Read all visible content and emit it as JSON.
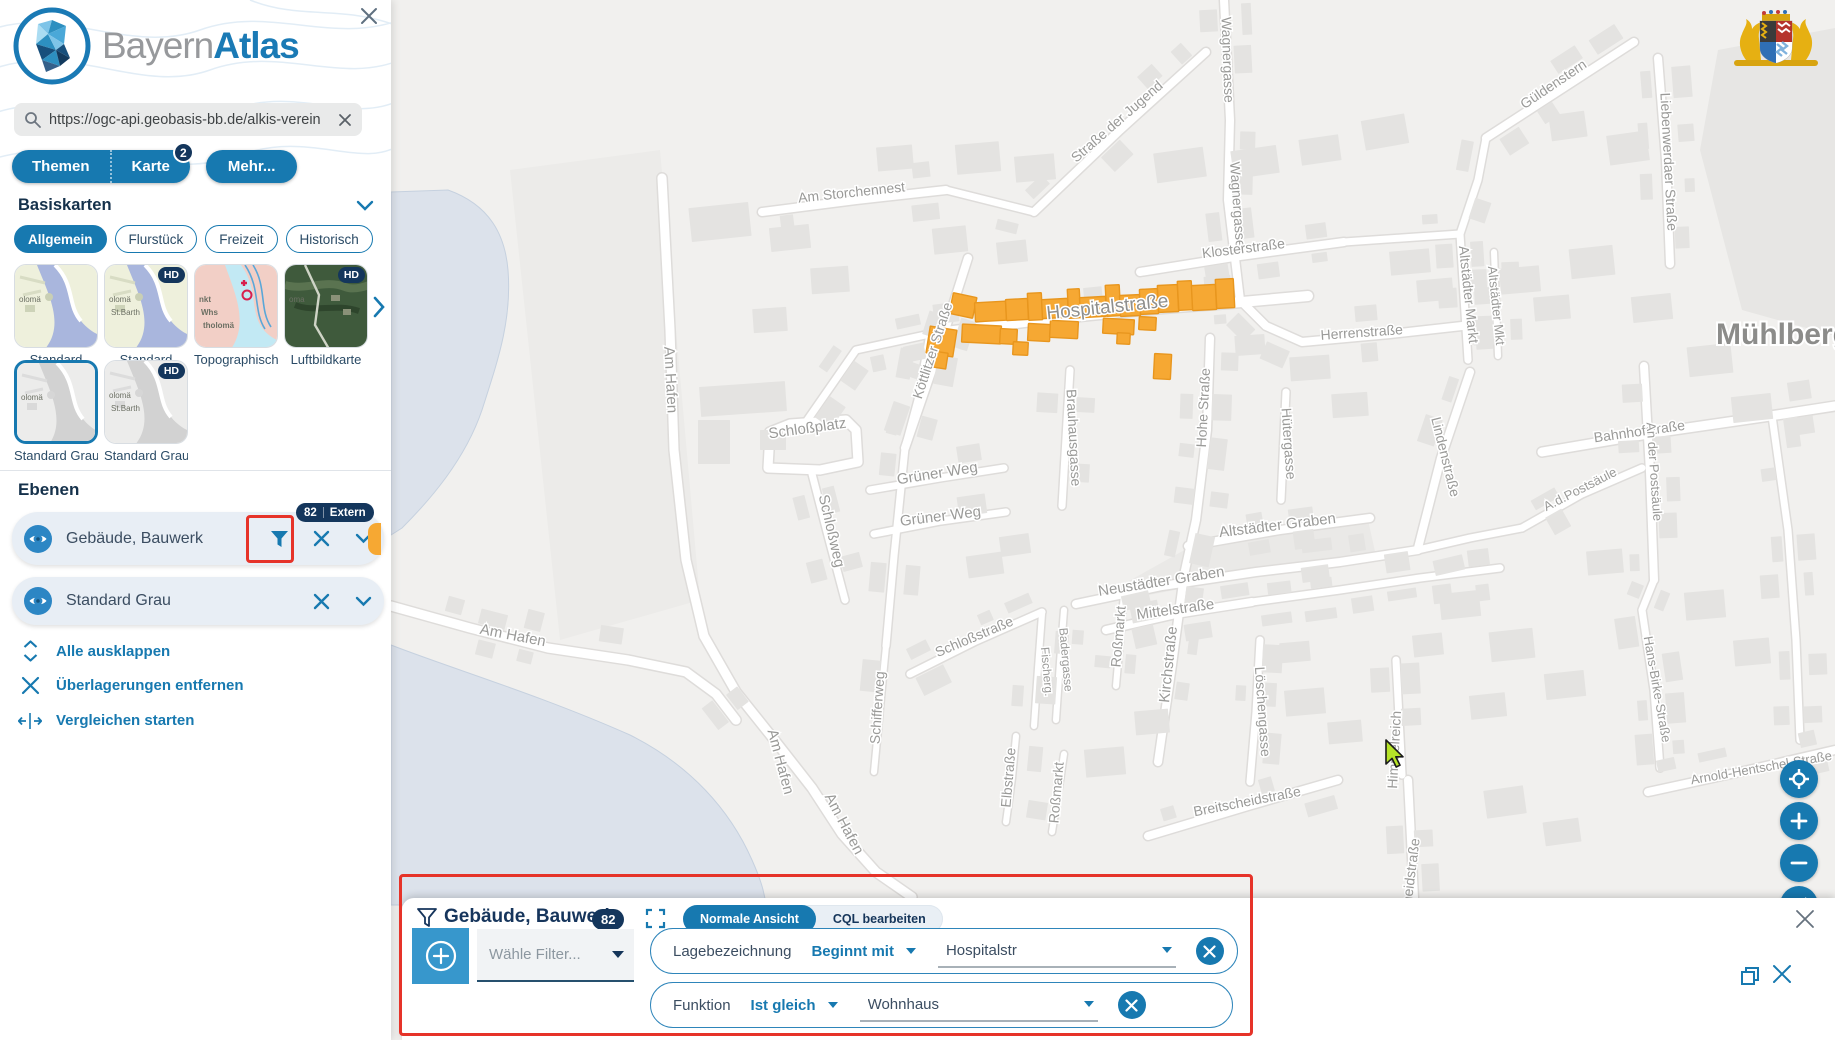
{
  "colors": {
    "primary": "#1779b0",
    "navy": "#14365c",
    "accent_orange": "#F6A833",
    "annotation_red": "#e63329",
    "layer_row_bg": "#e8eef5",
    "map_bg": "#f1f0ee",
    "water": "#dce2eb",
    "building": "#e4e3e1",
    "highlight_fill": "#F6A833",
    "highlight_stroke": "#E8961E"
  },
  "icons": [
    "close-icon",
    "search-icon",
    "chevron-down-icon",
    "chevron-right-icon",
    "filter-icon",
    "eye-icon",
    "expand-icon",
    "fullscreen-icon",
    "compare-icon",
    "plus-circle-icon",
    "zoom-in-icon",
    "zoom-out-icon",
    "geolocate-icon",
    "compass-icon",
    "restore-window-icon",
    "bavaria-coat-of-arms",
    "cursor-arrow"
  ],
  "sidebar": {
    "brand_gray": "Bayern",
    "brand_bold": "Atlas",
    "search": {
      "value": "https://ogc-api.geobasis-bb.de/alkis-verein"
    },
    "tabs": [
      {
        "label": "Themen"
      },
      {
        "label": "Karte",
        "badge": "2"
      },
      {
        "label": "Mehr..."
      }
    ],
    "basiskarten": {
      "title": "Basiskarten",
      "chips": [
        {
          "label": "Allgemein",
          "active": true
        },
        {
          "label": "Flurstück",
          "active": false
        },
        {
          "label": "Freizeit",
          "active": false
        },
        {
          "label": "Historisch",
          "active": false
        }
      ],
      "thumbs_row1": [
        {
          "label": "Standard",
          "variant": "standard",
          "hd": false,
          "overlay": [
            "olomä"
          ]
        },
        {
          "label": "Standard",
          "variant": "standard",
          "hd": true,
          "overlay": [
            "olomä",
            "St.Barth"
          ]
        },
        {
          "label": "Topographisch",
          "variant": "topo",
          "hd": false,
          "overlay": [
            "nkt",
            "Whs",
            "tholomä"
          ]
        },
        {
          "label": "Luftbildkarte",
          "variant": "aerial",
          "hd": true,
          "overlay": [
            "oma"
          ]
        }
      ],
      "thumbs_row2": [
        {
          "label": "Standard Grau",
          "variant": "gray",
          "hd": false,
          "selected": true,
          "overlay": [
            "olomä"
          ]
        },
        {
          "label": "Standard Grau",
          "variant": "gray",
          "hd": true,
          "overlay": [
            "olomä",
            "St.Barth"
          ]
        }
      ],
      "hd_badge": "HD"
    },
    "ebenen": {
      "title": "Ebenen",
      "layers": [
        {
          "label": "Gebäude, Bauwerk",
          "badge_count": "82",
          "badge_text": "Extern",
          "has_filter": true,
          "has_orange_handle": true
        },
        {
          "label": "Standard Grau",
          "has_filter": false
        }
      ],
      "actions": [
        {
          "label": "Alle ausklappen",
          "icon": "expand-vertical-icon"
        },
        {
          "label": "Überlagerungen entfernen",
          "icon": "close-icon"
        },
        {
          "label": "Vergleichen starten",
          "icon": "compare-icon"
        }
      ]
    }
  },
  "filter_panel": {
    "title": "Gebäude, Bauwerk",
    "count": "82",
    "view_toggle": [
      {
        "label": "Normale Ansicht",
        "active": true
      },
      {
        "label": "CQL bearbeiten",
        "active": false
      }
    ],
    "select_placeholder": "Wähle Filter...",
    "filters": [
      {
        "field": "Lagebezeichnung",
        "operator": "Beginnt mit",
        "value": "Hospitalstr"
      },
      {
        "field": "Funktion",
        "operator": "Ist gleich",
        "value": "Wohnhaus"
      }
    ]
  },
  "map": {
    "place_label": "Mühlberg",
    "street_labels": [
      {
        "t": "Wagnergasse",
        "x": 1223,
        "y": 60,
        "r": 88,
        "s": 14
      },
      {
        "t": "Wagnergasse",
        "x": 1233,
        "y": 205,
        "r": 86,
        "s": 14
      },
      {
        "t": "Straße der Jugend",
        "x": 1120,
        "y": 125,
        "r": -41,
        "s": 14
      },
      {
        "t": "Am Storchennest",
        "x": 852,
        "y": 197,
        "r": -6,
        "s": 14
      },
      {
        "t": "Güldenstern",
        "x": 1556,
        "y": 88,
        "r": -34,
        "s": 14
      },
      {
        "t": "Liebenwerdaer Straße",
        "x": 1664,
        "y": 162,
        "r": 87,
        "s": 14
      },
      {
        "t": "Klosterstraße",
        "x": 1244,
        "y": 253,
        "r": -7,
        "s": 14
      },
      {
        "t": "Altstädter Markt",
        "x": 1464,
        "y": 295,
        "r": 84,
        "s": 14
      },
      {
        "t": "Altstädter Mkt",
        "x": 1492,
        "y": 306,
        "r": 84,
        "s": 13
      },
      {
        "t": "Herrenstraße",
        "x": 1362,
        "y": 337,
        "r": -4,
        "s": 14
      },
      {
        "t": "Hohe Straße",
        "x": 1208,
        "y": 408,
        "r": -87,
        "s": 14
      },
      {
        "t": "Hütergasse",
        "x": 1284,
        "y": 444,
        "r": 86,
        "s": 14
      },
      {
        "t": "Lindenstraße",
        "x": 1441,
        "y": 458,
        "r": 76,
        "s": 14
      },
      {
        "t": "Bahnhofstraße",
        "x": 1640,
        "y": 436,
        "r": -8,
        "s": 14
      },
      {
        "t": "An der Postsäule",
        "x": 1650,
        "y": 472,
        "r": 86,
        "s": 13
      },
      {
        "t": "A.d.Postsäule",
        "x": 1582,
        "y": 493,
        "r": -27,
        "s": 13
      },
      {
        "t": "Altstädter Graben",
        "x": 1278,
        "y": 530,
        "r": -7,
        "s": 15
      },
      {
        "t": "Neustädter Graben",
        "x": 1162,
        "y": 586,
        "r": -9,
        "s": 15
      },
      {
        "t": "Mittelstraße",
        "x": 1176,
        "y": 614,
        "r": -8,
        "s": 15
      },
      {
        "t": "Kirchstraße",
        "x": 1173,
        "y": 665,
        "r": -84,
        "s": 15
      },
      {
        "t": "Löschengasse",
        "x": 1258,
        "y": 712,
        "r": 86,
        "s": 14
      },
      {
        "t": "Himmelreich",
        "x": 1399,
        "y": 750,
        "r": -87,
        "s": 14
      },
      {
        "t": "Breitscheidstraße",
        "x": 1248,
        "y": 806,
        "r": -11,
        "s": 14
      },
      {
        "t": "Breitscheidstraße",
        "x": 1413,
        "y": 893,
        "r": -83,
        "s": 14
      },
      {
        "t": "Hans-Birke-Straße",
        "x": 1653,
        "y": 690,
        "r": 80,
        "s": 13
      },
      {
        "t": "Arnold-Hentschel-Straße",
        "x": 1762,
        "y": 772,
        "r": -10,
        "s": 13
      },
      {
        "t": "Schloßplatz",
        "x": 808,
        "y": 433,
        "r": -8,
        "s": 15
      },
      {
        "t": "Schloßweg",
        "x": 827,
        "y": 532,
        "r": 77,
        "s": 15
      },
      {
        "t": "Grüner Weg",
        "x": 938,
        "y": 478,
        "r": -9,
        "s": 15
      },
      {
        "t": "Grüner Weg",
        "x": 941,
        "y": 521,
        "r": -7,
        "s": 15
      },
      {
        "t": "Schloßstraße",
        "x": 976,
        "y": 641,
        "r": -23,
        "s": 14
      },
      {
        "t": "Fischerg.",
        "x": 1043,
        "y": 672,
        "r": 85,
        "s": 12
      },
      {
        "t": "Badergasse",
        "x": 1062,
        "y": 660,
        "r": 85,
        "s": 12
      },
      {
        "t": "Brauhausgasse",
        "x": 1069,
        "y": 438,
        "r": 87,
        "s": 14
      },
      {
        "t": "Roßmarkt",
        "x": 1123,
        "y": 637,
        "r": -85,
        "s": 14
      },
      {
        "t": "Roßmarkt",
        "x": 1061,
        "y": 793,
        "r": -85,
        "s": 14
      },
      {
        "t": "Schifferweg",
        "x": 882,
        "y": 708,
        "r": -86,
        "s": 14
      },
      {
        "t": "Elbstraße",
        "x": 1013,
        "y": 778,
        "r": -85,
        "s": 14
      },
      {
        "t": "Am Hafen",
        "x": 666,
        "y": 380,
        "r": 87,
        "s": 15
      },
      {
        "t": "Am Hafen",
        "x": 512,
        "y": 640,
        "r": 11,
        "s": 15
      },
      {
        "t": "Am Hafen",
        "x": 776,
        "y": 763,
        "r": 75,
        "s": 15
      },
      {
        "t": "Am Hafen",
        "x": 840,
        "y": 826,
        "r": 62,
        "s": 15
      },
      {
        "t": "Köttlitzer Straße",
        "x": 937,
        "y": 352,
        "r": -72,
        "s": 14
      },
      {
        "t": "Hospitalstraße",
        "x": 1108,
        "y": 313,
        "r": -6,
        "s": 19,
        "cls": "street-major"
      }
    ],
    "orange_buildings": [
      {
        "x": 951,
        "y": 295,
        "w": 24,
        "h": 21,
        "r": 12
      },
      {
        "x": 975,
        "y": 302,
        "w": 31,
        "h": 19,
        "r": -3
      },
      {
        "x": 1006,
        "y": 299,
        "w": 22,
        "h": 21,
        "r": -3
      },
      {
        "x": 1028,
        "y": 293,
        "w": 14,
        "h": 27,
        "r": -3
      },
      {
        "x": 1042,
        "y": 299,
        "w": 26,
        "h": 19,
        "r": -3
      },
      {
        "x": 1068,
        "y": 289,
        "w": 12,
        "h": 29,
        "r": -3
      },
      {
        "x": 1080,
        "y": 297,
        "w": 26,
        "h": 20,
        "r": -3
      },
      {
        "x": 1106,
        "y": 285,
        "w": 14,
        "h": 31,
        "r": -3
      },
      {
        "x": 1120,
        "y": 295,
        "w": 20,
        "h": 21,
        "r": -3
      },
      {
        "x": 1140,
        "y": 289,
        "w": 18,
        "h": 25,
        "r": -3
      },
      {
        "x": 1158,
        "y": 285,
        "w": 20,
        "h": 27,
        "r": -3
      },
      {
        "x": 1178,
        "y": 281,
        "w": 14,
        "h": 29,
        "r": -3
      },
      {
        "x": 1192,
        "y": 285,
        "w": 24,
        "h": 25,
        "r": -3
      },
      {
        "x": 1216,
        "y": 279,
        "w": 18,
        "h": 29,
        "r": -3
      },
      {
        "x": 928,
        "y": 328,
        "w": 27,
        "h": 27,
        "r": 9
      },
      {
        "x": 932,
        "y": 352,
        "w": 15,
        "h": 16,
        "r": 9
      },
      {
        "x": 962,
        "y": 325,
        "w": 39,
        "h": 18,
        "r": 3
      },
      {
        "x": 1000,
        "y": 329,
        "w": 17,
        "h": 15,
        "r": 3
      },
      {
        "x": 1013,
        "y": 342,
        "w": 15,
        "h": 13,
        "r": 3
      },
      {
        "x": 1028,
        "y": 324,
        "w": 22,
        "h": 17,
        "r": 3
      },
      {
        "x": 1050,
        "y": 321,
        "w": 28,
        "h": 17,
        "r": 3
      },
      {
        "x": 1103,
        "y": 319,
        "w": 31,
        "h": 15,
        "r": 3
      },
      {
        "x": 1117,
        "y": 333,
        "w": 13,
        "h": 11,
        "r": 3
      },
      {
        "x": 1139,
        "y": 317,
        "w": 17,
        "h": 13,
        "r": 3
      },
      {
        "x": 1154,
        "y": 354,
        "w": 17,
        "h": 25,
        "r": 3
      }
    ]
  }
}
